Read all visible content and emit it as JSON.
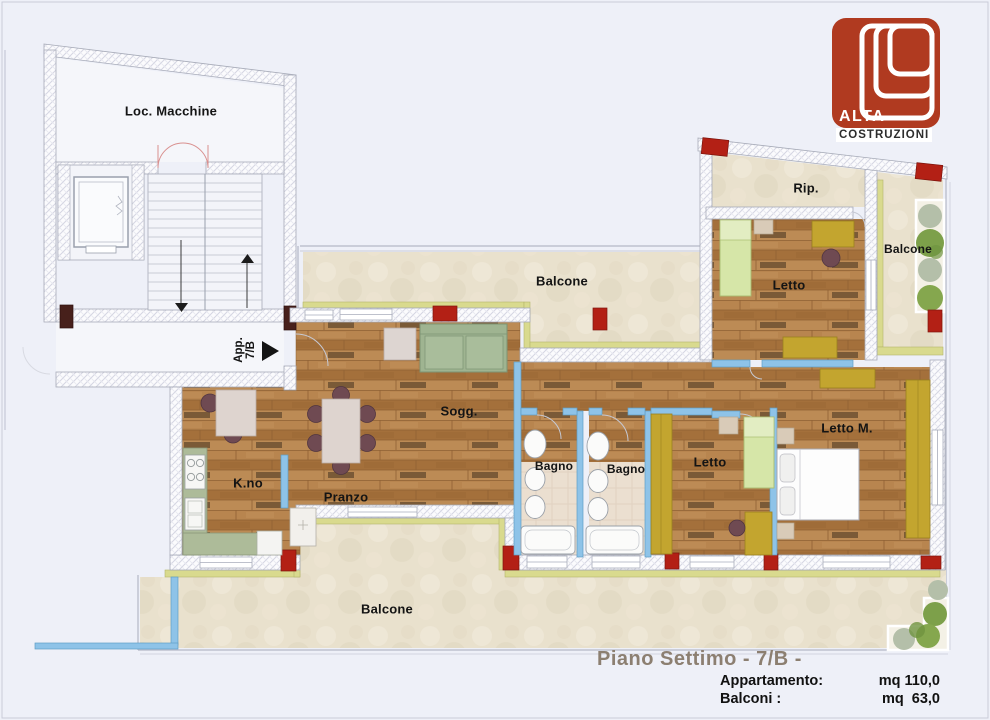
{
  "logo": {
    "name": "ALTA",
    "subtitle": "COSTRUZIONI",
    "color": "#b03a20"
  },
  "rooms": {
    "loc_macchine": "Loc. Macchine",
    "balcone_top": "Balcone",
    "balcone_right": "Balcone",
    "balcone_bottom": "Balcone",
    "rip": "Rip.",
    "letto_top": "Letto",
    "letto_mid": "Letto",
    "letto_master": "Letto M.",
    "soggiorno": "Sogg.",
    "bagno_1": "Bagno",
    "bagno_2": "Bagno",
    "cucina": "K.no",
    "pranzo": "Pranzo",
    "app_line1": "App.",
    "app_line2": "7/B"
  },
  "summary": {
    "title": "Piano Settimo - 7/B -",
    "apartment_label": "Appartamento:",
    "apartment_value": "mq 110,0",
    "balconies_label": "Balconi :",
    "balconies_value": "mq  63,0"
  },
  "colors": {
    "pillar_red": "#b32015",
    "wood_floor": "#b07d47",
    "balcony_tile": "#e9e1cd",
    "balcony_band": "#d9da8e",
    "partition_blue": "#8ec3e8",
    "kitchen_sage": "#adbb99",
    "bed_green": "#d6e6a8",
    "wardrobe_yellow": "#c3a52f",
    "title_text": "#8c7f71"
  }
}
